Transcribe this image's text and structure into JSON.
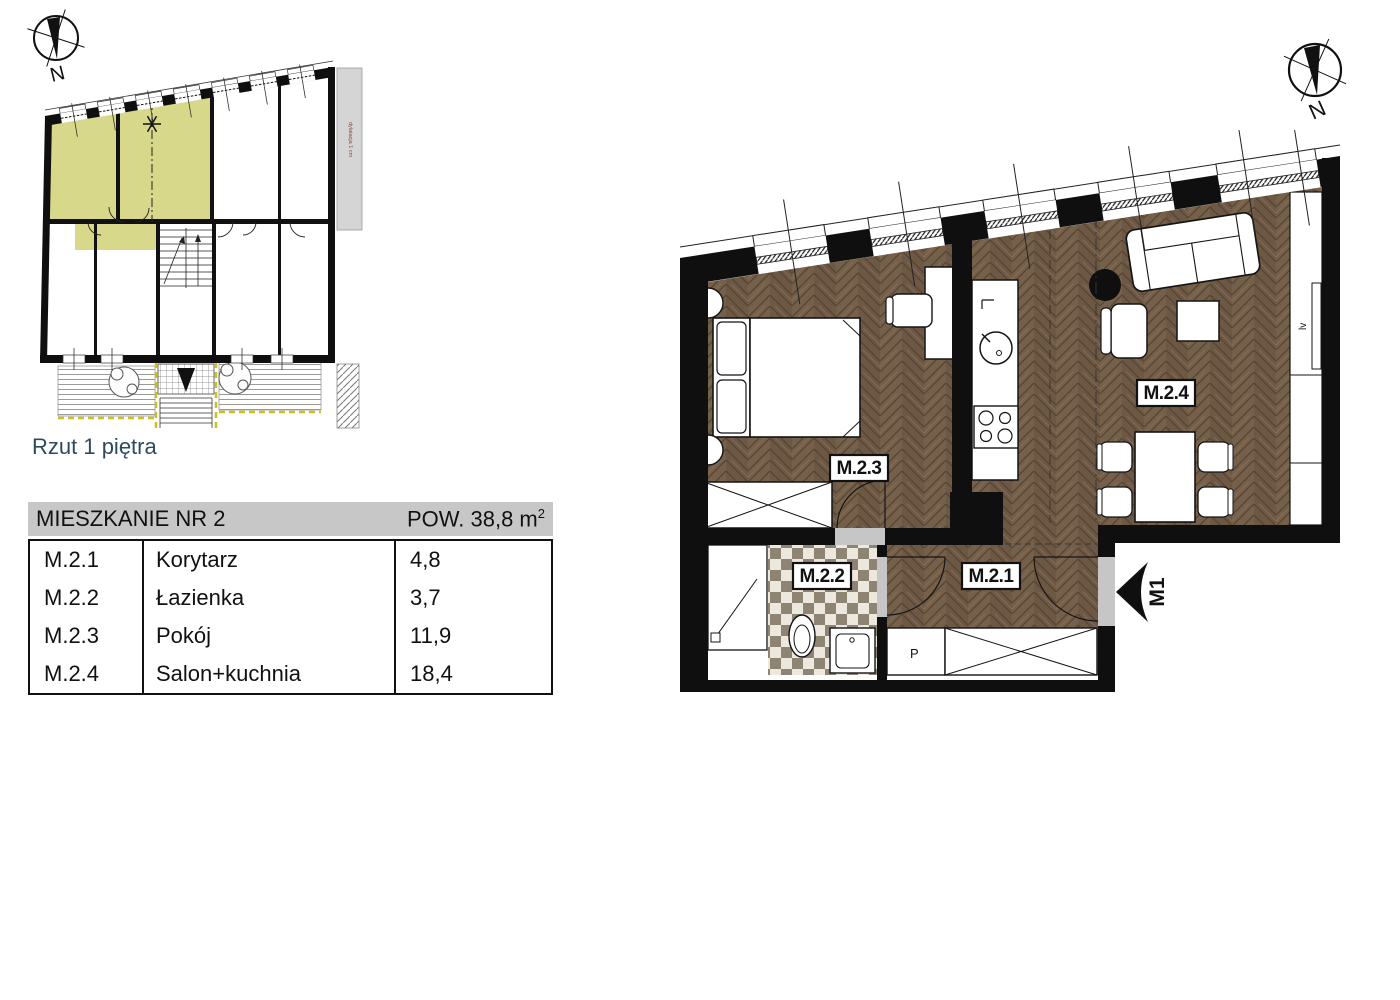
{
  "overview": {
    "caption": "Rzut 1 piętra",
    "compass_label": "N",
    "adjacent_building_note": "dylatacja 1 cm",
    "highlight_color": "#d8d88a",
    "terrace_dash_color": "#cdbf1d"
  },
  "main_plan": {
    "compass_label": "N",
    "labels": {
      "m21": "M.2.1",
      "m22": "M.2.2",
      "m23": "M.2.3",
      "m24": "M.2.4"
    },
    "entrance_label": "M1",
    "washer_label": "P",
    "radiator_label": "lv",
    "floor_color": "#75604c",
    "wall_color": "#0f0f0f"
  },
  "table": {
    "header": {
      "title": "MIESZKANIE NR 2",
      "area_label": "POW. 38,8 m",
      "area_sup": "2",
      "background": "#c7c7c7"
    },
    "rows": [
      {
        "code": "M.2.1",
        "name": "Korytarz",
        "area": "4,8"
      },
      {
        "code": "M.2.2",
        "name": "Łazienka",
        "area": "3,7"
      },
      {
        "code": "M.2.3",
        "name": "Pokój",
        "area": "11,9"
      },
      {
        "code": "M.2.4",
        "name": "Salon+kuchnia",
        "area": "18,4"
      }
    ]
  }
}
